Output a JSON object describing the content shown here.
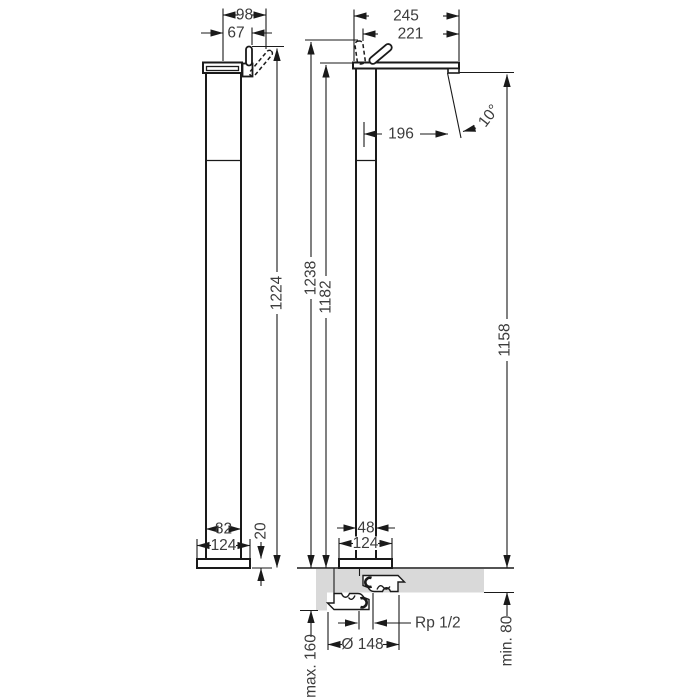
{
  "dimensions": {
    "side_view": {
      "spout_projection": "98",
      "handle_offset": "67",
      "height_total": "1224",
      "body_depth": "82",
      "base_depth": "124",
      "base_height": "20"
    },
    "front_view": {
      "reach_total": "245",
      "reach_to_handle": "221",
      "outlet_reach": "196",
      "spray_angle": "10°",
      "height_to_handle": "1238",
      "height_to_top": "1182",
      "height_to_outlet": "1158",
      "body_width": "48",
      "base_width": "124"
    },
    "installation": {
      "connection_thread": "Rp 1/2",
      "flange_diameter": "Ø 148",
      "floor_depth_max": "max. 160",
      "floor_depth_min": "min. 80"
    }
  },
  "colors": {
    "line": "#1a1a1a",
    "text": "#3c3c3c",
    "floor_fill": "#d9d9d9",
    "background": "#ffffff"
  }
}
